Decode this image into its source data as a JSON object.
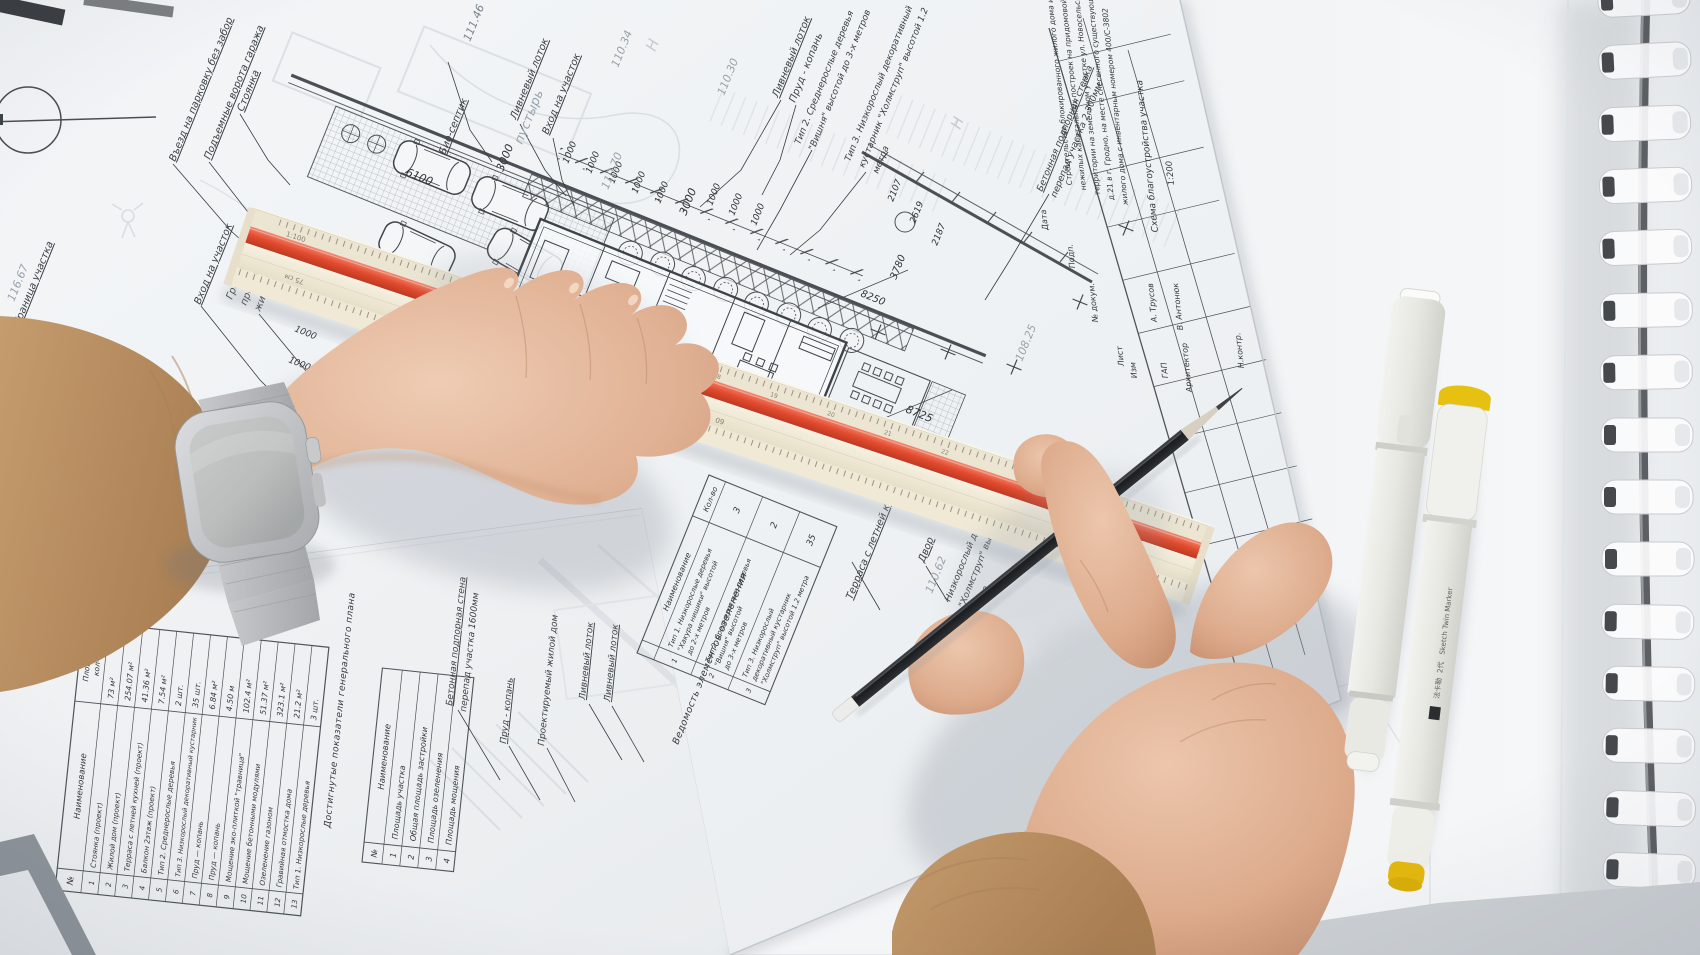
{
  "labels": {
    "granica_uchastka": "Граница участка",
    "vhod_na_uchastok": "Вход на участок",
    "granicy_1": "Границы",
    "granicy_2": "проектируемого",
    "granicy_3": "жилого дома",
    "vezd": "Въезд на парковку без забор",
    "vorota": "Подъемные ворота гаража",
    "stoyanka": "Стоянка",
    "bio_septik": "Био-септик",
    "livnevy_lotok": "Ливневый лоток",
    "prud_kopan": "Пруд - копань",
    "tip3_l1": "Тип 3. Низкорослый декоративный",
    "tip3_l2": "кустарник \"Холмструп\" высотой 1.2",
    "tip3_l3": "метра",
    "tip2_l1": "Тип 2. Среднерослые деревья",
    "tip2_l2": "\"Вишня\" высотой до 3-х метров",
    "beton_l1": "Бетонная подпорная стенка",
    "beton_l2": "перепад участка 2.300мм",
    "beton2_l1": "Бетонная подпорная стена",
    "beton2_l2": "перепад участка 1600мм",
    "proekt_dom": "Проектируемый жилой дом",
    "terrasa": "Терраса с летней кухней",
    "dvor": "Двор",
    "nizk_l1": "Низкорослый декоративный",
    "nizk_l2": "\"Холмструп\" высотой 1.2",
    "nizk_l3": "метра",
    "pustyr": "пустырь"
  },
  "dims": {
    "d6100": "6100",
    "d3000": "3000",
    "d1000": "1000",
    "d8725": "8725",
    "d8250": "8250",
    "d3780": "3780",
    "d2107": "2107",
    "d2619": "2619",
    "d2187": "2187",
    "d335": "335"
  },
  "elevations": {
    "e111_46": "111.46",
    "e110_34": "110.34",
    "e110_70": "110.70",
    "e110_30": "110.30",
    "e108_25": "108.25",
    "e110_62": "110.62",
    "e116_67": "116.67",
    "h": "Н"
  },
  "ruler": {
    "scale": "1:100",
    "n75": "75 см",
    "n70": "70",
    "n65": "65",
    "n60": "60",
    "t17": "17",
    "t18": "18",
    "t19": "19",
    "t20": "20",
    "t21": "21",
    "t22": "22"
  },
  "table_main": {
    "header": {
      "num": "№",
      "name": "Наименование",
      "area1": "Площадь/",
      "area2": "кол-во"
    },
    "rows": [
      {
        "num": "1",
        "name": "Стоянка (проект)",
        "value": "73 м²"
      },
      {
        "num": "2",
        "name": "Жилой дом (проект)",
        "value": "254.07 м²"
      },
      {
        "num": "3",
        "name": "Терраса с летней кухней (проект)",
        "value": "41.36 м²"
      },
      {
        "num": "4",
        "name": "Балкон 2этаж (проект)",
        "value": "7.54 м²"
      },
      {
        "num": "5",
        "name": "Тип 2. Среднерослые деревья",
        "value": "2 шт."
      },
      {
        "num": "6",
        "name": "Тип 3. Низкорослый декоративный кустарник",
        "value": "35 шт."
      },
      {
        "num": "7",
        "name": "Пруд — копань",
        "value": "6.84 м²"
      },
      {
        "num": "8",
        "name": "Пруд — копань",
        "value": "4.50 м"
      },
      {
        "num": "9",
        "name": "Мощение эко-плиткой \"травница\"",
        "value": "102.4 м²"
      },
      {
        "num": "10",
        "name": "Мощение бетонными модулями",
        "value": "51.37 м²"
      },
      {
        "num": "11",
        "name": "Озеленение газоном",
        "value": "323.1 м²"
      },
      {
        "num": "12",
        "name": "Гравийная отмостка дома",
        "value": "21.2 м²"
      },
      {
        "num": "13",
        "name": "Тип 1. Низкорослые деревья",
        "value": "3 шт."
      }
    ]
  },
  "table_indicators": {
    "title": "Достигнутые показатели генерального плана",
    "header": {
      "num": "№",
      "name": "Наименование"
    },
    "rows": [
      {
        "num": "1",
        "name": "Площадь участка"
      },
      {
        "num": "2",
        "name": "Общая площадь застройки"
      },
      {
        "num": "3",
        "name": "Площадь озеленения"
      },
      {
        "num": "4",
        "name": "Площадь мощения"
      }
    ]
  },
  "table_greenery": {
    "title": "Ведомость элементов озеленения",
    "header": {
      "name": "Наименование",
      "qty": "Кол-во"
    },
    "rows": [
      {
        "num": "1",
        "l1": "Тип 1. Низкорослые деревья",
        "l2": "\"Хакура нишики\" высотой",
        "l3": "до 2-х метров",
        "qty": "3"
      },
      {
        "num": "2",
        "l1": "Тип 2. Среднерослые деревья",
        "l2": "\"Вишня\" высотой",
        "l3": "до 3-х метров",
        "qty": "2"
      },
      {
        "num": "3",
        "l1": "Тип 3. Низкорослый",
        "l2": "декоративный кустарник",
        "l3": "\"Холмструп\" высотой 1.2 метра",
        "qty": "35"
      }
    ]
  },
  "title_block": {
    "desc": {
      "l1": "Строительство блокированного жилого дома и",
      "l2": "нежилых капитальных построек на придомовой",
      "l3": "территории на земельном участке ул. Новосельская,",
      "l4": "д.21 в г. Гродно, на месте снесенного существующего",
      "l5": "жилого дома с инвентарным номером 400/С-3802"
    },
    "scheme": "Схема благоустройства участка",
    "scale": "1:200",
    "cols": {
      "izm": "Изм",
      "list": "Лист",
      "doc": "№ докум.",
      "sign": "Подп.",
      "date": "Дата"
    },
    "roles": {
      "gap": "ГАП",
      "gap_name": "А. Трусов",
      "arch": "Архитектор",
      "arch_name": "В. Антонюк",
      "ncontr": "Н.контр."
    }
  },
  "marker": {
    "cn": "法卡勒",
    "gen": "2代",
    "brand": "Sketch Twin Marker"
  }
}
